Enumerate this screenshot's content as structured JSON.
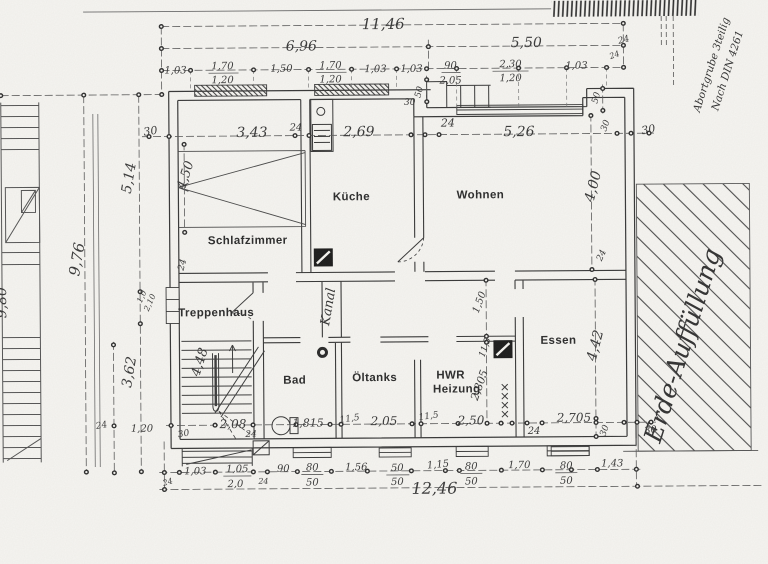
{
  "drawing": {
    "rooms": {
      "schlafzimmer": "Schlafzimmer",
      "kueche": "Küche",
      "wohnen": "Wohnen",
      "treppenhaus": "Treppenhaus",
      "bad": "Bad",
      "oeltanks": "Öltanks",
      "hwr_line1": "HWR",
      "hwr_line2": "Heizung",
      "essen": "Essen",
      "kanal": "Kanal"
    },
    "site": {
      "erde": "Erde-Auffüllung",
      "abort1": "Abortgrube 3teilig",
      "abort2": "Nach DIN 4261"
    },
    "dims": {
      "t_overall": "11,46",
      "t_left": "6,96",
      "t_right": "5,50",
      "t_right_24": "24",
      "a1": "1,03",
      "a2": "1,70",
      "a2b": "1,20",
      "a3": "1,50",
      "a4": "1,70",
      "a4b": "1,20",
      "a5": "1,03",
      "a6": "1,03",
      "a7": "90",
      "a7b": "2,05",
      "a8": "2,30",
      "a8b": "1,20",
      "a9": "1,03",
      "a10": "24",
      "b0": "30",
      "b1": "3,43",
      "b2": "24",
      "b3": "2,69",
      "b4": "30",
      "b5": "50",
      "b6": "24",
      "b7": "5,26",
      "b8": "50",
      "b9": "30",
      "b10": "30",
      "lv_980": "9,80",
      "lv_976": "9,76",
      "lv_514": "5,14",
      "lv_10": "1,0",
      "lv_210": "2,10",
      "lv_362": "3,62",
      "lv_24": "24",
      "lv_120": "1,20",
      "lv_450": "4,50",
      "lv_w24": "24",
      "lv_448": "4,48",
      "rv_400": "4,00",
      "rv_442": "4,42",
      "rv_150": "1,50",
      "rv_115": "11,5",
      "rv_2805": "2,805",
      "rv_24": "24",
      "c0": "30",
      "c1": "2,08",
      "c2": "24",
      "c3": "1,815",
      "c4": "11,5",
      "c5": "2,05",
      "c6": "11,5",
      "c7": "2,50",
      "c8": "24",
      "c9": "2,705",
      "c10": "30",
      "c11": "30",
      "d0": "24",
      "d1": "1,03",
      "d2": "1,05",
      "d2b": "2,0",
      "d3": "24",
      "d4": "90",
      "d5": "80",
      "d5b": "50",
      "d6": "1,56",
      "d7": "50",
      "d7b": "50",
      "d8": "1,15",
      "d9": "80",
      "d9b": "50",
      "d10": "1,70",
      "d11": "80",
      "d11b": "50",
      "d12": "1,43",
      "total_bottom": "12,46"
    }
  }
}
